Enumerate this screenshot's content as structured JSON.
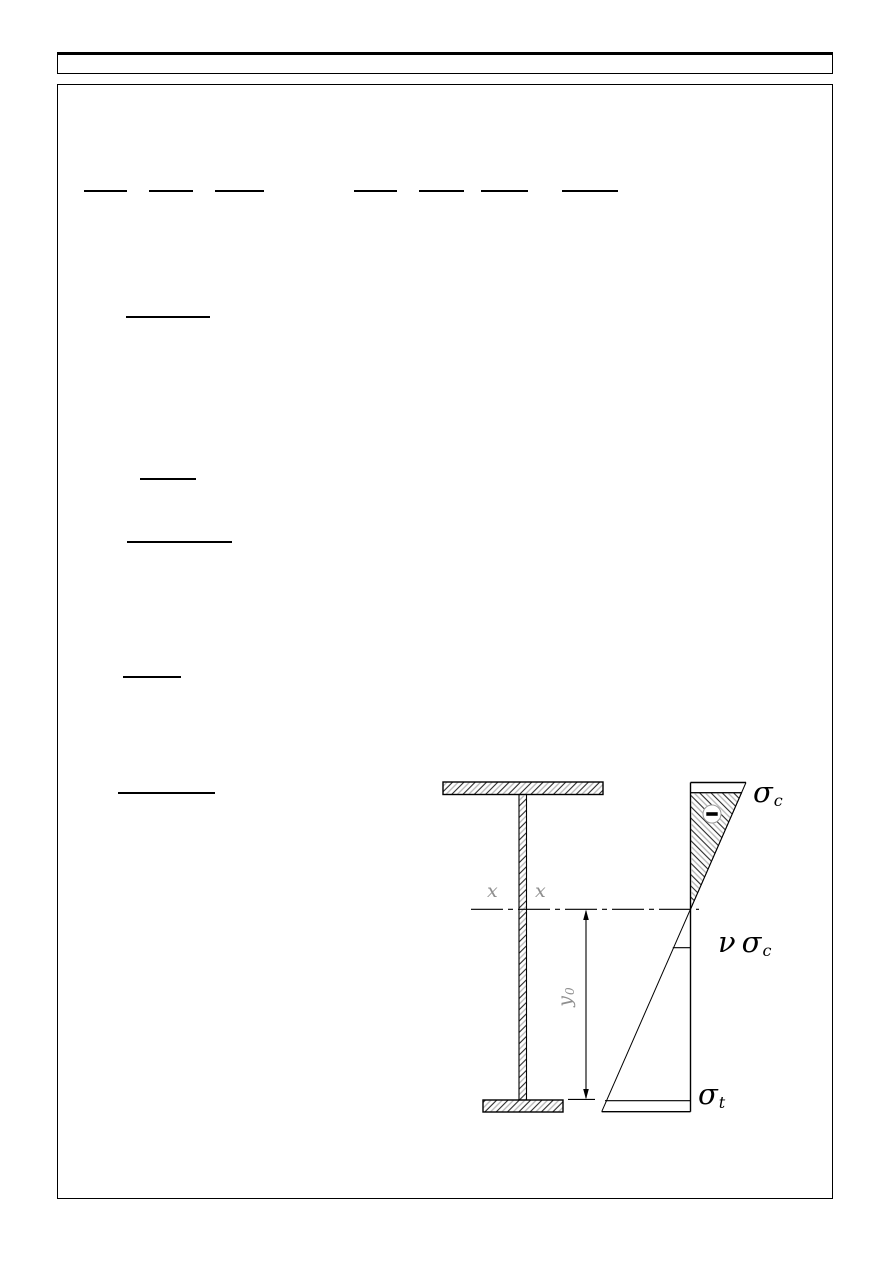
{
  "page": {
    "background": "#ffffff",
    "ink": "#000000",
    "description_visible_text_only": true
  },
  "figure": {
    "labels": {
      "sigma_c": {
        "base": "σ",
        "sub": "c"
      },
      "nu_sigma_c": {
        "prefix": "ν",
        "base": "σ",
        "sub": "c"
      },
      "sigma_t": {
        "base": "σ",
        "sub": "t"
      },
      "x_left": "x",
      "x_right": "x",
      "y0": {
        "base": "y",
        "sub": "0"
      },
      "minus": "−"
    },
    "colors": {
      "hatch_dark": "#2a2a2a",
      "hatch_gray": "#b5b5b5",
      "annotation_gray": "#8f8f8f",
      "line": "#000000"
    }
  }
}
